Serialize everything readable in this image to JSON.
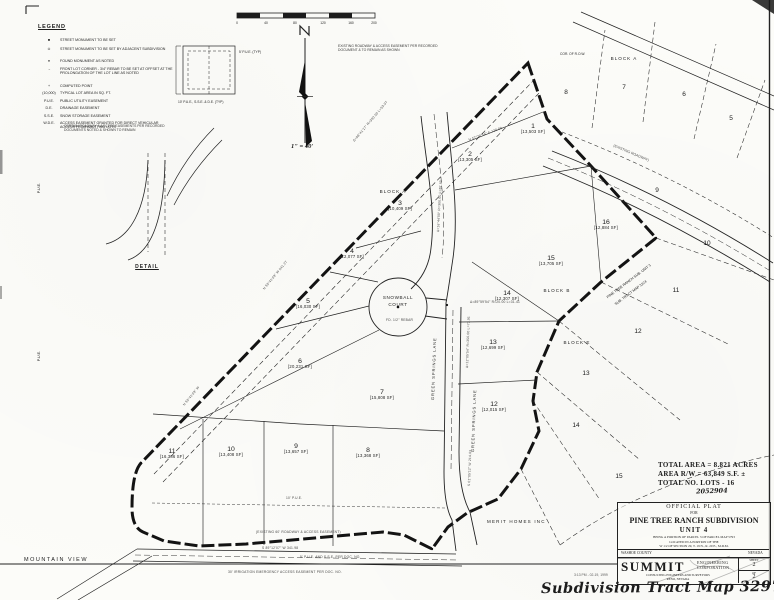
{
  "colors": {
    "ink": "#1c1c1c",
    "paper": "#fcfcf9"
  },
  "legend": {
    "title": "LEGEND",
    "items": [
      {
        "symbol": "■",
        "text": "STREET MONUMENT TO BE SET"
      },
      {
        "symbol": "⊙",
        "text": "STREET MONUMENT TO BE SET BY ADJACENT SUBDIVISION"
      },
      {
        "symbol": "●",
        "text": "FOUND MONUMENT AS NOTED"
      },
      {
        "symbol": "→",
        "text": "FRONT LOT CORNER - 3/4\" REBAR TO BE SET AT OFFSET AT THE PROLONGATION OF THE LOT LINE AS NOTED"
      },
      {
        "symbol": "+",
        "text": "COMPUTED POINT"
      },
      {
        "symbol": "(10,000)",
        "text": "TYPICAL LOT AREA IN SQ. FT."
      },
      {
        "symbol": "P.U.E.",
        "text": "PUBLIC UTILITY EASEMENT"
      },
      {
        "symbol": "D.E.",
        "text": "DRAINAGE EASEMENT"
      },
      {
        "symbol": "S.S.E.",
        "text": "SNOW STORAGE EASEMENT"
      },
      {
        "symbol": "W.D.E.",
        "text": "ACCESS EASEMENT GRANTED FOR DIRECT VEHICULAR ACCESS FROM ABUTTING LOTS"
      }
    ]
  },
  "scale_bar": {
    "labels": [
      "0",
      "40",
      "80",
      "120",
      "160",
      "200"
    ],
    "scale_note": "1\" = 40'"
  },
  "notes": {
    "existing_easement": "EXISTING ROADWAY & ACCESS EASEMENT PER RECORDED DOCUMENT & TO REMAIN AS SHOWN",
    "monument_note": "CERTAIN ROADWAY & ACCESS EASEMENTS PER RECORDED DOCUMENTS NOTED & SHOWN TO REMAIN",
    "detail_label": "DETAIL",
    "typical_easement_top": "5' P.U.E. (TYP)",
    "typical_easement_bottom": "10' P.U.E., S.S.E. & D.E. (TYP)",
    "pue_left": "P.U.E.",
    "corner_row": "COR. OF R.O.W.",
    "existing_roadway": "(EXISTING ROADWAY)"
  },
  "map": {
    "street_snowball_1": "SNOWBALL",
    "street_snowball_2": "COURT",
    "street_ns": "GREEN SPRINGS LANE",
    "owner": "MERIT HOMES INC",
    "area_sw": "MOUNTAIN VIEW",
    "adjacent_sub_1": "PINE TREE RANCH SUB. UNIT 3",
    "adjacent_sub_2": "SUB. TRACT MAP 3224",
    "blocks": [
      "BLOCK A",
      "BLOCK A",
      "BLOCK B",
      "BLOCK E"
    ],
    "lots": [
      {
        "number": "1",
        "area": "[13,503 SF]"
      },
      {
        "number": "2",
        "area": "[13,305 SF]"
      },
      {
        "number": "3",
        "area": "[10,409 SF]"
      },
      {
        "number": "4",
        "area": "[12,077 SF]"
      },
      {
        "number": "5",
        "area": "[16,030 SF]"
      },
      {
        "number": "6",
        "area": "[20,231 SF]"
      },
      {
        "number": "7",
        "area": "[15,808 SF]"
      },
      {
        "number": "8",
        "area": "[13,368 SF]"
      },
      {
        "number": "9",
        "area": "[13,657 SF]"
      },
      {
        "number": "10",
        "area": "[13,408 SF]"
      },
      {
        "number": "11",
        "area": "[16,386 SF]"
      },
      {
        "number": "12",
        "area": "[12,015 SF]"
      },
      {
        "number": "13",
        "area": "[12,699 SF]"
      },
      {
        "number": "14",
        "area": "[12,307 SF]"
      },
      {
        "number": "15",
        "area": "[13,705 SF]"
      },
      {
        "number": "16",
        "area": "[12,884 SF]"
      }
    ],
    "adjacent_lots": [
      "8",
      "7",
      "6",
      "5",
      "9",
      "10",
      "11",
      "12",
      "13",
      "14",
      "15"
    ],
    "annotations": [
      "N 50°41'03\" W  541.27",
      "N 50°41'03\" W",
      "N 57°20'54\" E  120.00",
      "Δ=16°44'00\"  R=300.00  L=87.65",
      "Δ=12°05'54\"  R=350.00  L=73.91",
      "Δ=89°59'54\"  R=20.00  L=31.41",
      "S 01°05'12\" W  214.63",
      "S 89°12'07\" W  341.98",
      "(EXISTING 60' ROADWAY & ACCESS EASEMENT)",
      "30' IRRIGATION EMERGENCY ACCESS EASEMENT PER DOC. NO.",
      "5' P.U.E. AND S.S.E. PER DOC. NO.",
      "10' P.U.E.",
      "Δ=08°41'17\"  R=350.00  L=53.07",
      "FD. 1/2\" REBAR"
    ]
  },
  "stats": {
    "line1": "TOTAL AREA = 8.821 ACRES",
    "line2": "AREA R/W = 63,849 S.F. ±",
    "line3": "TOTAL NO. LOTS - 16",
    "doc_number": "2052904"
  },
  "title_block": {
    "official_plat": "OFFICIAL PLAT",
    "for": "FOR",
    "subdivision": "PINE TREE RANCH SUBDIVISION",
    "unit": "UNIT 4",
    "desc1": "BEING A PORTION OF PARCEL 3 OF PARCEL MAP 5793",
    "desc2": "LOCATED IN A PORTION OF THE",
    "desc3": "W 1/2 OF SECTION 29, T. 19 N., R. 20 E., M.D.M.",
    "county": "WASHOE COUNTY",
    "state": "NEVADA"
  },
  "summit_block": {
    "name": "SUMMIT",
    "line1": "ENGINEERING",
    "line2": "CORPORATION",
    "tagline": "CONSULTING ENGINEERS AND SURVEYORS",
    "city": "RENO, NEVADA",
    "sheet_label": "SHEET",
    "sheet_no": "2",
    "of_label": "OF",
    "of_no": "2"
  },
  "stamp": "3:13 PM - 02-19, 1999",
  "handwriting": "Subdivision Tract Map 3297A"
}
